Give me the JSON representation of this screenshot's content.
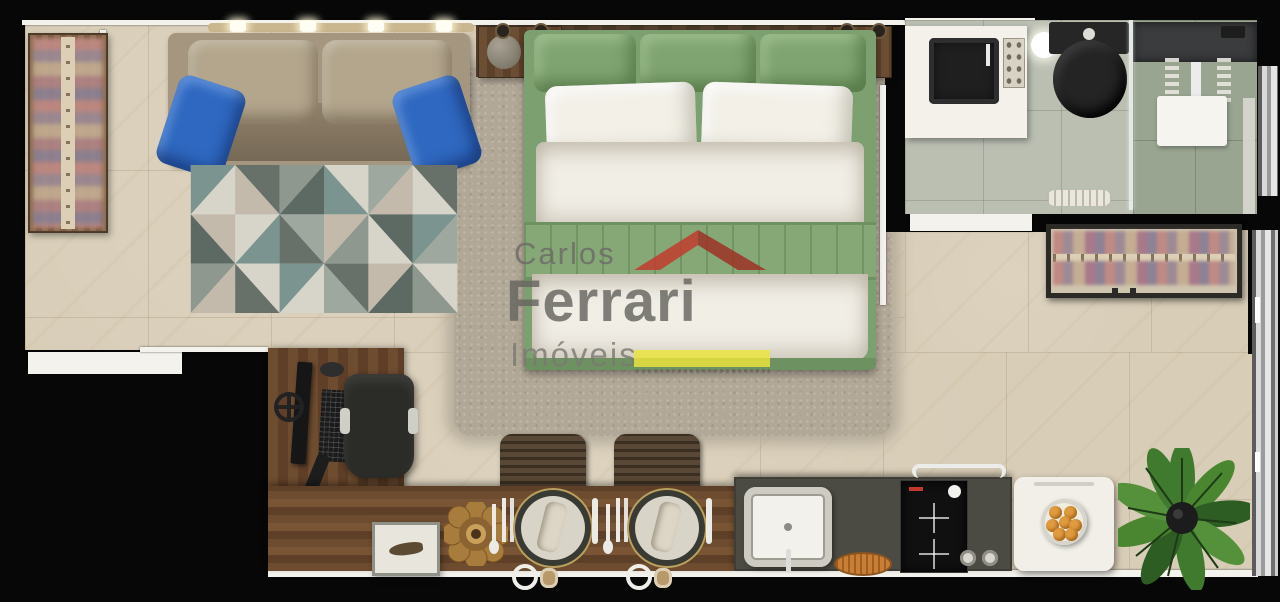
{
  "meta": {
    "description": "Top-down 3D rendered floor plan of a studio apartment, real-estate listing image",
    "canvas": {
      "width": 1280,
      "height": 602
    }
  },
  "watermark": {
    "brand_top": "Carlos",
    "brand_main": "Ferrari",
    "brand_sub": "Imóveis",
    "roof_icon": "red-roof-logo",
    "roof_color": "#c23a2c",
    "roof_shadow_color": "#9e2f23",
    "underline_color": "#ece63b",
    "text_color": "#6c6b66"
  },
  "palette": {
    "background": "#060606",
    "floor_marble": "#d8cdb7",
    "wall_white": "#f4f2ec",
    "wood_furniture": "#6e4c30",
    "bathroom_floor": "#babfb2",
    "shower_floor": "#99a491",
    "bed_green": "#7ca06f",
    "linen_white": "#f1eee6",
    "sofa_taupe": "#a5977f",
    "pillow_blue": "#2f68c0",
    "kitchen_counter_grey": "#4c4b43",
    "cooktop_black": "#101010",
    "plant_green": "#3f7a2e",
    "fruit_orange": "#e09a3f"
  },
  "rooms": [
    {
      "name": "living-area"
    },
    {
      "name": "bedroom-area"
    },
    {
      "name": "bathroom"
    },
    {
      "name": "kitchen-dining"
    },
    {
      "name": "balcony-edge"
    }
  ],
  "items": [
    "wardrobe-with-clothes-left",
    "ceiling-spot-rail",
    "sofa-with-blue-pillows",
    "geometric-rug",
    "shag-rug",
    "double-bed-green-linen",
    "nightstand-left",
    "nightstand-right",
    "bathroom-vanity-black-sink",
    "black-toilet",
    "glass-shower",
    "towel-roll",
    "clothes-rack-right",
    "work-desk",
    "monitor",
    "keyboard",
    "office-chair",
    "dining-counter",
    "dining-chair-1",
    "dining-chair-2",
    "place-setting-1",
    "place-setting-2",
    "white-side-table",
    "gold-flower-bowl",
    "kitchen-sink",
    "orange-dish",
    "two-burner-cooktop",
    "control-knobs",
    "white-appliance-module",
    "fruit-bowl",
    "potted-plant",
    "bathroom-window",
    "balcony-sliding-door"
  ]
}
